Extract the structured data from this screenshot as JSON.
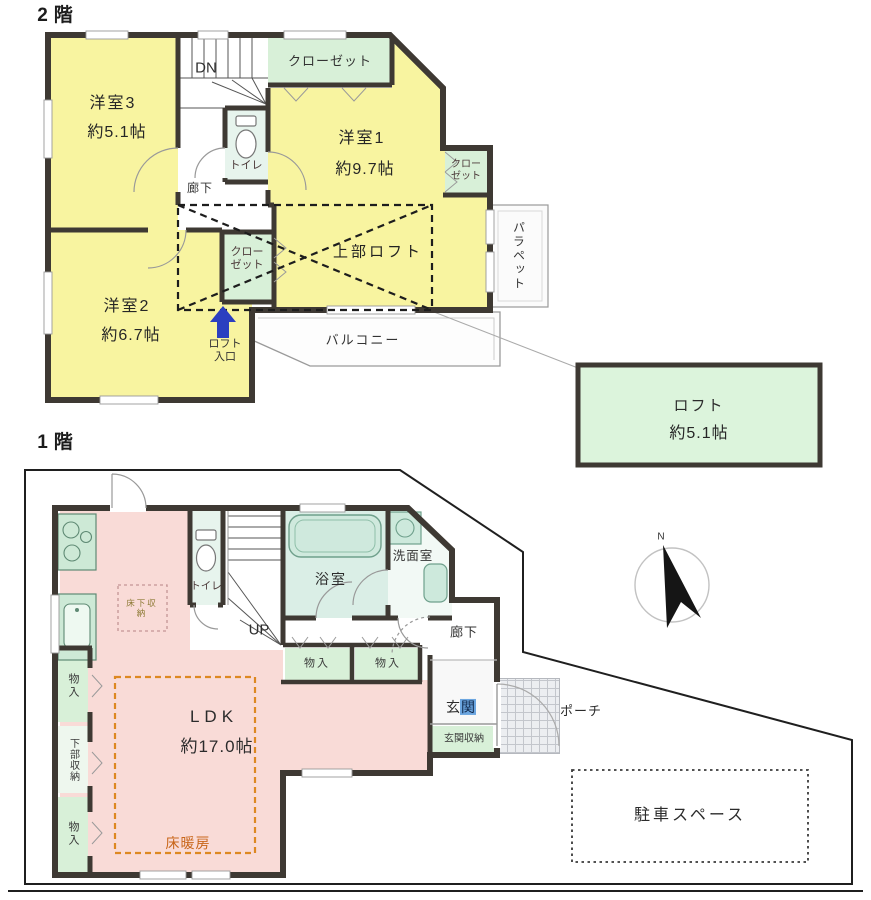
{
  "floor2": {
    "title": "2階",
    "rooms": {
      "yoshitsu3_name": "洋室3",
      "yoshitsu3_size": "約5.1帖",
      "yoshitsu1_name": "洋室1",
      "yoshitsu1_size": "約9.7帖",
      "yoshitsu2_name": "洋室2",
      "yoshitsu2_size": "約6.7帖",
      "closet_top": "クローゼット",
      "closet_side": "クローゼット",
      "closet_mid": "クローゼット",
      "toilet": "トイレ",
      "hallway": "廊下",
      "stairs_down": "DN",
      "upper_loft": "上部ロフト",
      "loft_entrance": "ロフト入口",
      "balcony": "バルコニー",
      "parapet": "パラペット"
    },
    "loft_box": {
      "name": "ロフト",
      "size": "約5.1帖"
    }
  },
  "floor1": {
    "title": "1階",
    "rooms": {
      "ldk_name": "LDK",
      "ldk_size": "約17.0帖",
      "bath": "浴室",
      "washroom": "洗面室",
      "toilet": "トイレ",
      "hallway": "廊下",
      "stairs_up": "UP",
      "genkan_char1": "玄",
      "genkan_char2": "関",
      "genkan_storage": "玄関収納",
      "storage_row_a": "物入",
      "storage_row_b": "物入",
      "storage_left_top": "物入",
      "lower_storage": "下部収納",
      "storage_left_bottom": "物入",
      "floor_storage": "床下収納",
      "floor_heating": "床暖房",
      "porch": "ポーチ",
      "parking": "駐車スペース"
    },
    "compass_north": "N"
  },
  "colors": {
    "wall": "#3e3933",
    "room_yellow": "#f8f4a0",
    "closet_green": "#d8f0d8",
    "ldk_pink": "#f9dbd7",
    "bath_green": "#daeee6",
    "heating_orange": "#dd8822",
    "loft_arrow_blue": "#2b3fc0",
    "selection_blue": "#6ca6e0"
  }
}
